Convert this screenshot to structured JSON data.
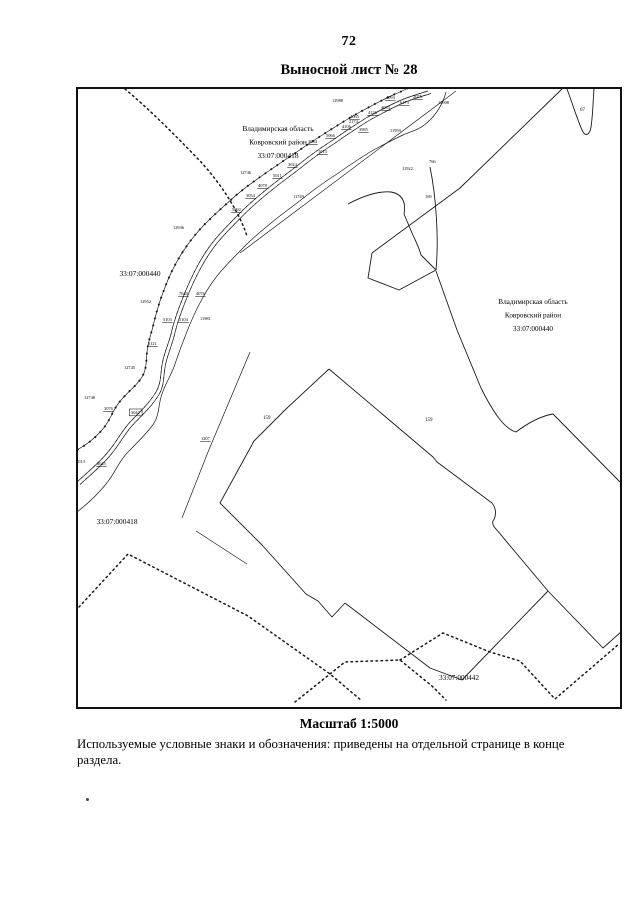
{
  "page": {
    "number": "72",
    "title": "Выносной лист № 28"
  },
  "footer": {
    "scale_label": "Масштаб 1:5000",
    "note": "Используемые условные знаки и обозначения: приведены на отдельной странице в конце раздела."
  },
  "map": {
    "region_labels": [
      {
        "lines": [
          "Владимирская область",
          "Ковровский район",
          "33:07:000418"
        ],
        "x": 278,
        "y": 131,
        "lh": 13.5,
        "fs": 7.4
      },
      {
        "lines": [
          "33:07:000440"
        ],
        "x": 140,
        "y": 276,
        "lh": 13,
        "fs": 7.4
      },
      {
        "lines": [
          "Владимирская область",
          "Ковровский район",
          "33:07:000440"
        ],
        "x": 533,
        "y": 304,
        "lh": 13.5,
        "fs": 7.2
      },
      {
        "lines": [
          "33:07:000418"
        ],
        "x": 117,
        "y": 524,
        "lh": 13,
        "fs": 7.4
      },
      {
        "lines": [
          "33:07:000442"
        ],
        "x": 459,
        "y": 680,
        "lh": 13,
        "fs": 7.2
      }
    ],
    "point_labels": [
      {
        "x": 332,
        "y": 102,
        "t": "12988"
      },
      {
        "x": 438,
        "y": 104,
        "t": "12908"
      },
      {
        "x": 349,
        "y": 123,
        "t": "2174"
      },
      {
        "x": 390,
        "y": 132,
        "t": "11959"
      },
      {
        "x": 402,
        "y": 170,
        "t": "11922"
      },
      {
        "x": 429,
        "y": 163,
        "t": "766"
      },
      {
        "x": 425,
        "y": 198,
        "t": "169"
      },
      {
        "x": 580,
        "y": 111,
        "t": "67",
        "s": 5
      },
      {
        "x": 263,
        "y": 419,
        "t": "159",
        "s": 5
      },
      {
        "x": 425,
        "y": 421,
        "t": "159",
        "s": 5
      },
      {
        "x": 386,
        "y": 99,
        "t": "4093",
        "u": 1
      },
      {
        "x": 400,
        "y": 104,
        "t": "6173",
        "u": 1
      },
      {
        "x": 413,
        "y": 98,
        "t": "2075",
        "u": 1
      },
      {
        "x": 381,
        "y": 109,
        "t": "4063",
        "u": 1
      },
      {
        "x": 368,
        "y": 114,
        "t": "4126",
        "u": 1
      },
      {
        "x": 350,
        "y": 118,
        "t": "4065",
        "u": 1
      },
      {
        "x": 342,
        "y": 128,
        "t": "4106",
        "u": 1
      },
      {
        "x": 359,
        "y": 131,
        "t": "3985",
        "u": 1
      },
      {
        "x": 326,
        "y": 137,
        "t": "5066",
        "u": 1
      },
      {
        "x": 308,
        "y": 143,
        "t": "3064",
        "u": 1
      },
      {
        "x": 318,
        "y": 153,
        "t": "1013",
        "u": 1
      },
      {
        "x": 288,
        "y": 166,
        "t": "3024",
        "u": 1
      },
      {
        "x": 273,
        "y": 177,
        "t": "5011",
        "u": 1
      },
      {
        "x": 258,
        "y": 187,
        "t": "4078",
        "u": 1
      },
      {
        "x": 246,
        "y": 197,
        "t": "3054",
        "u": 1
      },
      {
        "x": 232,
        "y": 211,
        "t": "5092",
        "u": 1
      },
      {
        "x": 240,
        "y": 174,
        "t": "12746"
      },
      {
        "x": 293,
        "y": 198,
        "t": "11749"
      },
      {
        "x": 173,
        "y": 229,
        "t": "12936"
      },
      {
        "x": 140,
        "y": 303,
        "t": "12952"
      },
      {
        "x": 200,
        "y": 320,
        "t": "11981"
      },
      {
        "x": 179,
        "y": 295,
        "t": "7640",
        "u": 1
      },
      {
        "x": 196,
        "y": 295,
        "t": "4076",
        "u": 1
      },
      {
        "x": 163,
        "y": 321,
        "t": "5103",
        "u": 1
      },
      {
        "x": 179,
        "y": 321,
        "t": "5104",
        "u": 1
      },
      {
        "x": 148,
        "y": 345,
        "t": "5121",
        "u": 1
      },
      {
        "x": 124,
        "y": 369,
        "t": "12745"
      },
      {
        "x": 84,
        "y": 399,
        "t": "12748"
      },
      {
        "x": 104,
        "y": 410,
        "t": "3076",
        "u": 1
      },
      {
        "x": 131,
        "y": 414,
        "t": "3042",
        "b": 1
      },
      {
        "x": 201,
        "y": 440,
        "t": "1207",
        "u": 1
      },
      {
        "x": 76,
        "y": 463,
        "t": "7013"
      },
      {
        "x": 97,
        "y": 465,
        "t": "6045",
        "u": 1
      }
    ]
  }
}
